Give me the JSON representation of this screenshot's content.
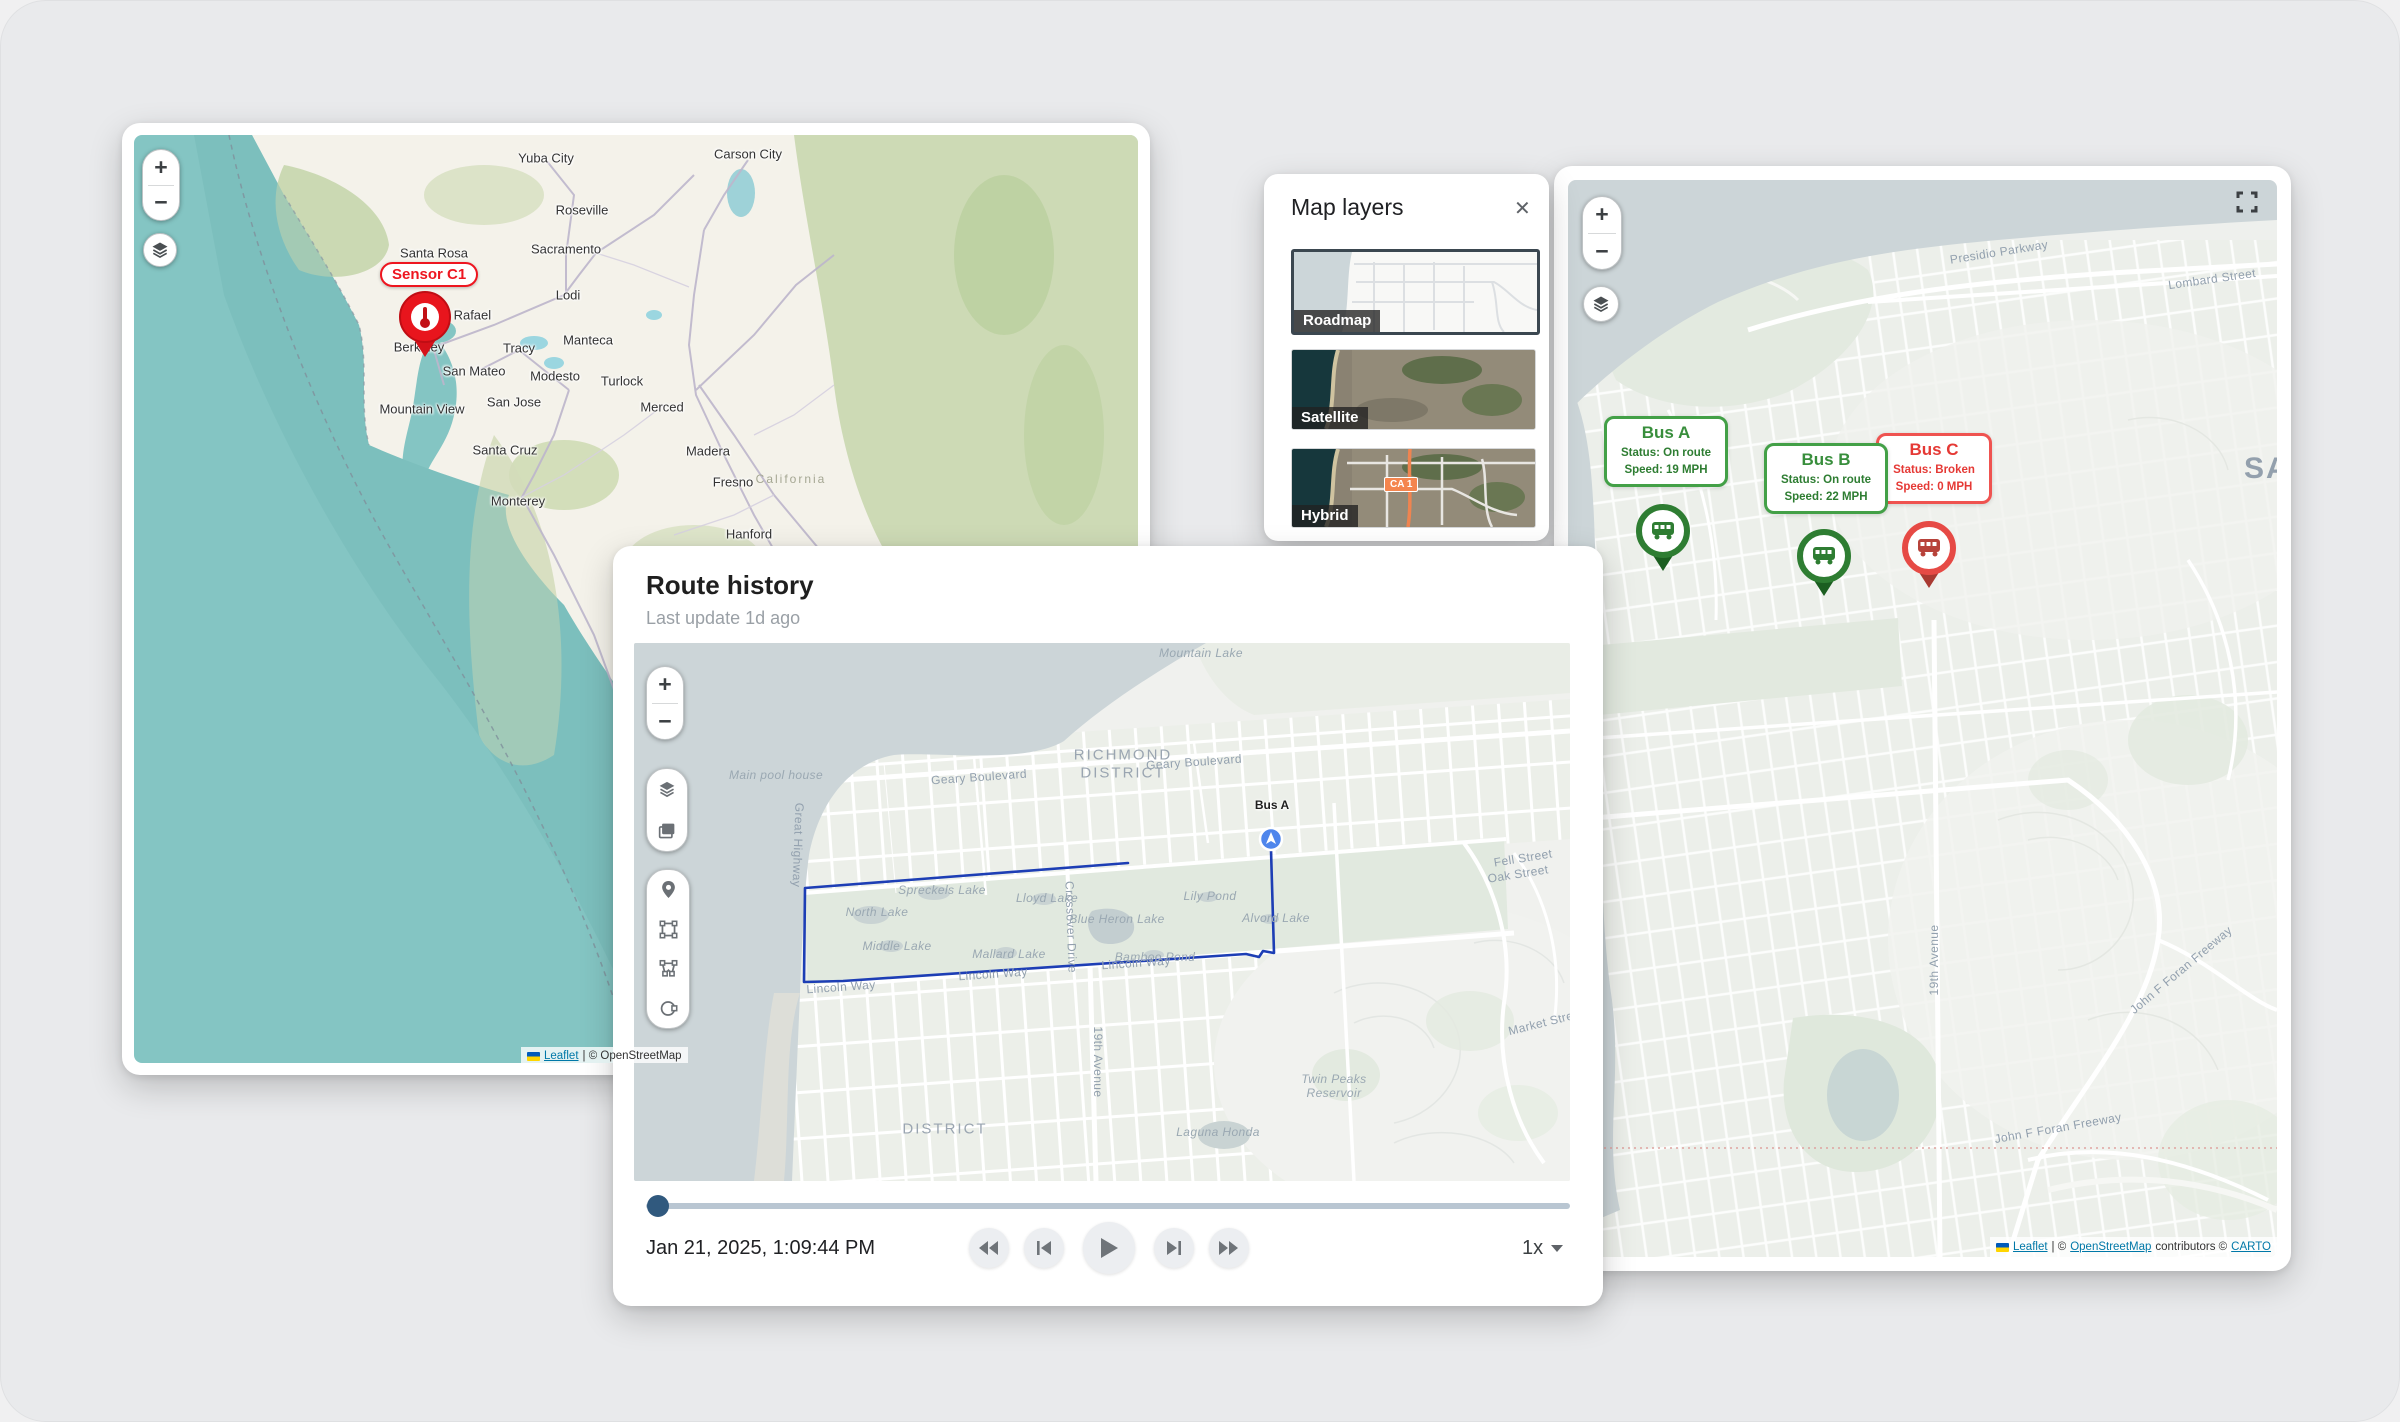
{
  "colors": {
    "accent_ok": "#2e7d32",
    "accent_alert": "#e53935",
    "sensor_red": "#ee1620",
    "route_blue": "#1d3eb5",
    "slider_thumb": "#30597e",
    "ocean_teal": "#84c5c3",
    "carto_water": "#ccd5d8"
  },
  "sensor_map": {
    "zoom_in": "+",
    "zoom_out": "−",
    "sensor_label": "Sensor C1",
    "cities": {
      "yuba_city": "Yuba City",
      "carson_city": "Carson City",
      "roseville": "Roseville",
      "sacramento": "Sacramento",
      "santa_rosa": "Santa Rosa",
      "lodi": "Lodi",
      "san_rafael": "San Rafael",
      "manteca": "Manteca",
      "berkeley": "Berkeley",
      "tracy": "Tracy",
      "san_mateo": "San Mateo",
      "modesto": "Modesto",
      "turlock": "Turlock",
      "mountain_view": "Mountain View",
      "san_jose": "San Jose",
      "merced": "Merced",
      "santa_cruz": "Santa Cruz",
      "madera": "Madera",
      "fresno": "Fresno",
      "monterey": "Monterey",
      "hanford": "Hanford",
      "california": "California"
    },
    "attribution": {
      "leaflet": "Leaflet",
      "rest": "| © OpenStreetMap"
    }
  },
  "map_layers_panel": {
    "title": "Map layers",
    "close_label": "✕",
    "roadmap_label": "Roadmap",
    "satellite_label": "Satellite",
    "hybrid_label": "Hybrid",
    "hybrid_badge": "CA 1"
  },
  "fleet_map": {
    "zoom_in": "+",
    "zoom_out": "−",
    "buses": [
      {
        "name": "Bus A",
        "status": "Status: On route",
        "speed": "Speed: 19 MPH"
      },
      {
        "name": "Bus B",
        "status": "Status: On route",
        "speed": "Speed: 22 MPH"
      },
      {
        "name": "Bus C",
        "status": "Status: Broken",
        "speed": "Speed: 0 MPH"
      }
    ],
    "labels": {
      "presidio": "Presidio Parkway",
      "lombard": "Lombard Street",
      "city_partial": "SA",
      "avenue_19": "19th Avenue",
      "foran_a": "John F Foran Freeway",
      "foran_b": "John F Foran Freeway"
    },
    "attribution": {
      "leaflet": "Leaflet",
      "sep": "| ©",
      "osm": "OpenStreetMap",
      "middle": "contributors ©",
      "carto": "CARTO"
    }
  },
  "route_history": {
    "title": "Route history",
    "subtitle": "Last update 1d ago",
    "timestamp": "Jan 21, 2025, 1:09:44 PM",
    "speed_label": "1x",
    "zoom_in": "+",
    "zoom_out": "−",
    "bus_label": "Bus A",
    "map_labels": {
      "mountain_lake": "Mountain Lake",
      "main_pool_house": "Main pool house",
      "richmond": "RICHMOND",
      "district_richmond": "DISTRICT",
      "geary_1": "Geary Boulevard",
      "geary_2": "Geary Boulevard",
      "great_highway": "Great Highway",
      "spreckels": "Spreckels Lake",
      "north_lake": "North Lake",
      "middle_lake": "Middle Lake",
      "mallard": "Mallard Lake",
      "lloyd": "Lloyd Lake",
      "crossover": "Crossover Drive",
      "blue_heron": "Blue Heron Lake",
      "bamboo": "Bamboo Pond",
      "lily": "Lily Pond",
      "alvord": "Alvord Lake",
      "lincoln_1": "Lincoln Way",
      "lincoln_2": "Lincoln Way",
      "lincoln_3": "Lincoln Way",
      "fell": "Fell Street",
      "oak": "Oak Street",
      "market": "Market Street",
      "avenue_19": "19th Avenue",
      "district_sunset": "DISTRICT",
      "laguna_honda": "Laguna Honda",
      "twin_peaks_1": "Twin Peaks",
      "twin_peaks_2": "Reservoir"
    }
  }
}
